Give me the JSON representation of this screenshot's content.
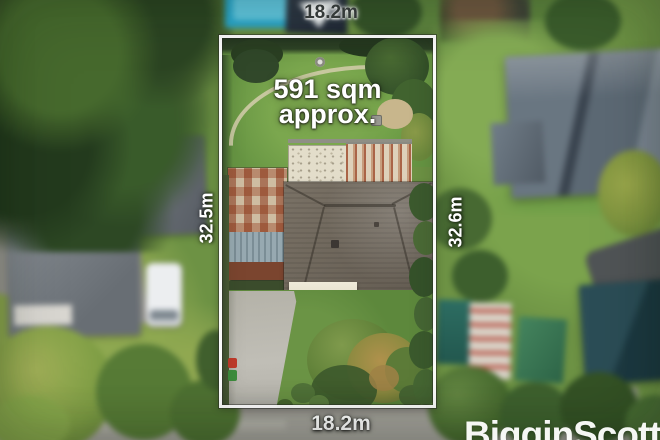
{
  "annotations": {
    "frontage_top": "18.2m",
    "frontage_bottom": "18.2m",
    "side_left": "32.5m",
    "side_right": "32.6m",
    "area_line1": "591 sqm",
    "area_line2": "approx."
  },
  "branding": {
    "agency_name": "BigginScott"
  },
  "palette": {
    "boundary_line": "#ffffff",
    "label_light": "#ffffff",
    "label_dark": "#393e3e",
    "lawn_green": "#679543",
    "roof_gray": "#6e665b",
    "rust_roof": "#9a5738",
    "pool_teal": "#2da2c3",
    "street_gray": "#a5a39c"
  }
}
